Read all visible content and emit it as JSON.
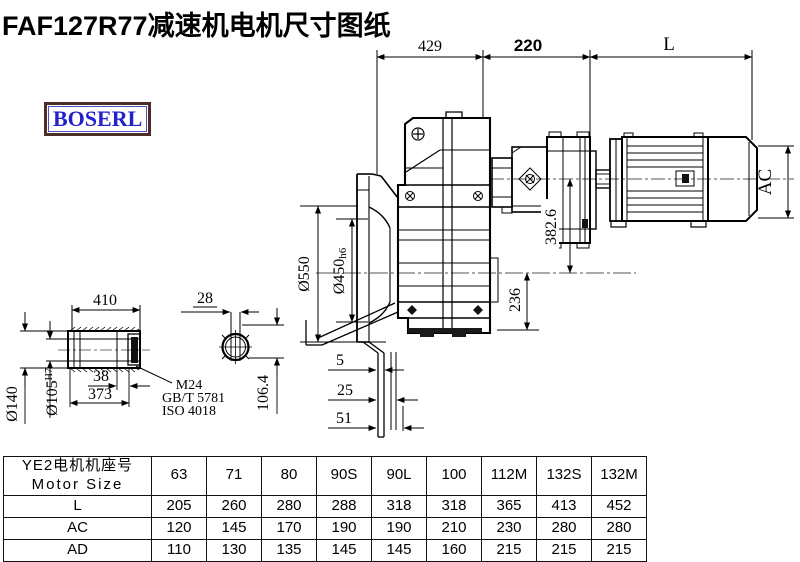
{
  "title": "FAF127R77减速机电机尺寸图纸",
  "logo": {
    "text": "BOSERL",
    "text_color": "#2222cc",
    "border_color": "#4c2e26"
  },
  "drawing": {
    "dims": {
      "width_429": "429",
      "width_220": "220",
      "motor_len": "L",
      "motor_ac": "AC",
      "flange_od": "Ø550",
      "flange_fit": "Ø450",
      "flange_fit_tol": "h6",
      "center_dist": "382.6",
      "axis_bottom": "236",
      "plate_5": "5",
      "plate_25": "25",
      "plate_51": "51",
      "shaft_410": "410",
      "shaft_od": "Ø140",
      "shaft_bore": "Ø105",
      "shaft_bore_tol": "H7",
      "dim_38": "38",
      "dim_373": "373",
      "key_28": "28",
      "key_106": "106.4",
      "thread": "M24",
      "std1": "GB/T 5781",
      "std2": "ISO 4018"
    }
  },
  "table": {
    "header_cn": "YE2电机机座号",
    "header_en": "Motor Size",
    "col_headers": [
      "63",
      "71",
      "80",
      "90S",
      "90L",
      "100",
      "112M",
      "132S",
      "132M"
    ],
    "rows": [
      {
        "label": "L",
        "values": [
          "205",
          "260",
          "280",
          "288",
          "318",
          "318",
          "365",
          "413",
          "452"
        ]
      },
      {
        "label": "AC",
        "values": [
          "120",
          "145",
          "170",
          "190",
          "190",
          "210",
          "230",
          "280",
          "280"
        ]
      },
      {
        "label": "AD",
        "values": [
          "110",
          "130",
          "135",
          "145",
          "145",
          "160",
          "215",
          "215",
          "215"
        ]
      }
    ]
  }
}
